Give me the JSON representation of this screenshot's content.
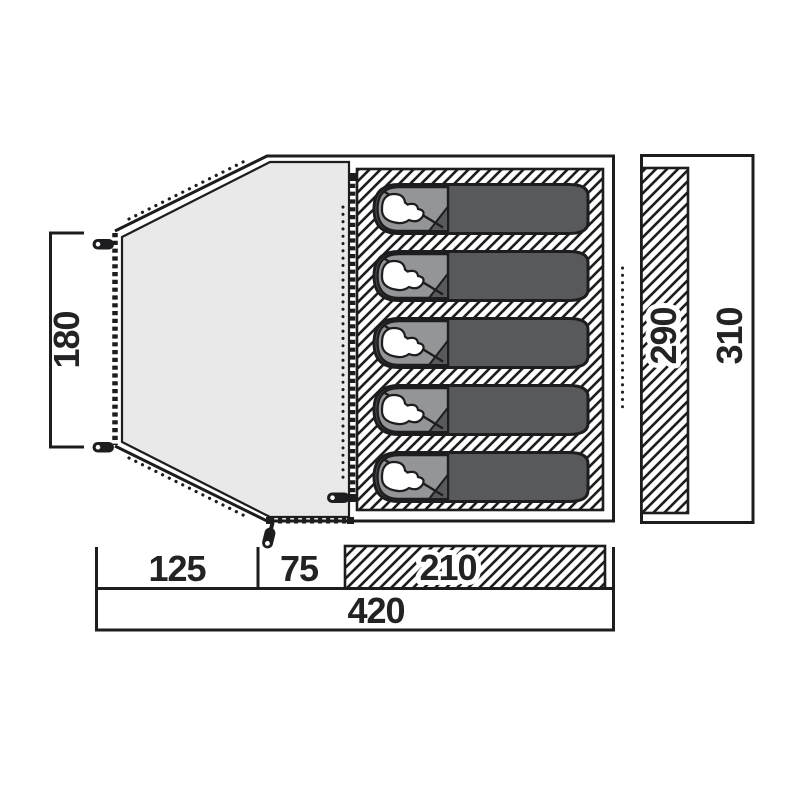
{
  "figure": {
    "title": "tent floor plan top view",
    "sleeping_bag_count": 5,
    "dimensions": {
      "door_height": "180",
      "segment_porch": "125",
      "segment_middle": "75",
      "segment_cabin": "210",
      "total_width": "420",
      "side_inner": "290",
      "side_outer": "310"
    },
    "colors": {
      "line": "#1d1d1f",
      "porch_fill": "#e9e9e9",
      "bag_fill": "#58595b",
      "hood_fill": "#939597"
    }
  }
}
